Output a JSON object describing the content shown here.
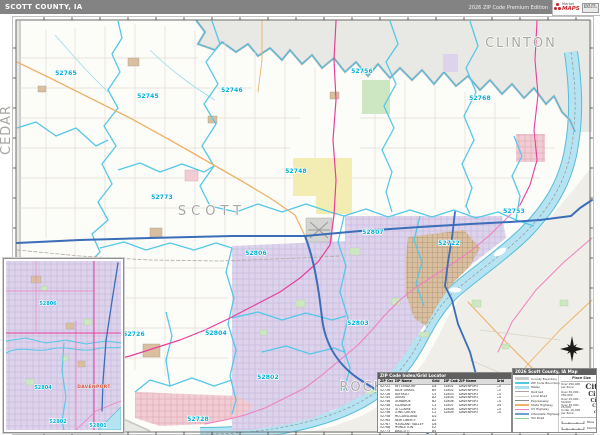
{
  "header": {
    "title": "SCOTT COUNTY, IA",
    "edition": "2026 ZIP Code Premium Edition",
    "logo": {
      "brand_top": "Market",
      "brand_bottom": "MAPS",
      "badge": "2026 ZIP Reference"
    }
  },
  "map": {
    "county_labels": [
      {
        "text": "SCOTT",
        "x": 212,
        "y": 215,
        "size": 13,
        "spacing": 5
      },
      {
        "text": "CLINTON",
        "x": 521,
        "y": 47,
        "size": 11,
        "spacing": 2
      },
      {
        "text": "ROCK ISLAND",
        "x": 395,
        "y": 391,
        "size": 12,
        "spacing": 2
      },
      {
        "text": "CEDAR",
        "x": 10,
        "y": 130,
        "size": 4.5,
        "spacing": 1,
        "rotate": -90
      }
    ],
    "zip_labels": [
      {
        "code": "52765",
        "x": 66,
        "y": 75
      },
      {
        "code": "52745",
        "x": 148,
        "y": 98
      },
      {
        "code": "52746",
        "x": 232,
        "y": 92
      },
      {
        "code": "52756",
        "x": 362,
        "y": 73
      },
      {
        "code": "52768",
        "x": 480,
        "y": 100
      },
      {
        "code": "52748",
        "x": 296,
        "y": 173
      },
      {
        "code": "52773",
        "x": 162,
        "y": 199
      },
      {
        "code": "52753",
        "x": 514,
        "y": 213
      },
      {
        "code": "52807",
        "x": 373,
        "y": 234
      },
      {
        "code": "52806",
        "x": 256,
        "y": 255
      },
      {
        "code": "52722",
        "x": 449,
        "y": 245
      },
      {
        "code": "52804",
        "x": 216,
        "y": 335
      },
      {
        "code": "52803",
        "x": 358,
        "y": 325
      },
      {
        "code": "52802",
        "x": 268,
        "y": 379
      },
      {
        "code": "52726",
        "x": 134,
        "y": 336
      },
      {
        "code": "52728",
        "x": 198,
        "y": 421
      }
    ]
  },
  "inset": {
    "city": {
      "text": "DAVENPORT",
      "x": 88,
      "y": 127
    },
    "zip_labels": [
      {
        "code": "52806",
        "x": 42,
        "y": 44
      },
      {
        "code": "52804",
        "x": 37,
        "y": 128
      },
      {
        "code": "52802",
        "x": 52,
        "y": 162
      },
      {
        "code": "52801",
        "x": 92,
        "y": 166
      }
    ]
  },
  "zip_table": {
    "title": "ZIP Code Index/Grid Locator",
    "columns": [
      "ZIP Code",
      "ZIP Name",
      "Grid"
    ],
    "rows_left": [
      [
        "52722",
        "BETTENDORF",
        "D4"
      ],
      [
        "52726",
        "BLUE GRASS",
        "B5"
      ],
      [
        "52728",
        "BUFFALO",
        "C5"
      ],
      [
        "52745",
        "DIXON",
        "A2"
      ],
      [
        "52746",
        "DONAHUE",
        "B2"
      ],
      [
        "52748",
        "ELDRIDGE",
        "C3"
      ],
      [
        "52753",
        "LE CLAIRE",
        "E3"
      ],
      [
        "52756",
        "LONG GROVE",
        "C2"
      ],
      [
        "52758",
        "MCCAUSLAND",
        "D2"
      ],
      [
        "52765",
        "NEW LIBERTY",
        "A2"
      ],
      [
        "52767",
        "PLEASANT VALLEY",
        "D4"
      ],
      [
        "52768",
        "PRINCETON",
        "E2"
      ],
      [
        "52773",
        "WALCOTT",
        "B4"
      ]
    ],
    "rows_right": [
      [
        "52801",
        "DAVENPORT",
        "C4"
      ],
      [
        "52802",
        "DAVENPORT",
        "C5"
      ],
      [
        "52803",
        "DAVENPORT",
        "C4"
      ],
      [
        "52804",
        "DAVENPORT",
        "C4"
      ],
      [
        "52806",
        "DAVENPORT",
        "C4"
      ],
      [
        "52807",
        "DAVENPORT",
        "D4"
      ],
      [
        "52808",
        "DAVENPORT",
        "C4"
      ],
      [
        "52809",
        "DAVENPORT",
        "C4"
      ]
    ]
  },
  "legend": {
    "title": "2026 Scott County, IA Map",
    "lines": [
      {
        "label": "County Boundary",
        "color": "#c9c9c9",
        "h": 2.6
      },
      {
        "label": "ZIP Code Boundary",
        "color": "#55c8e8",
        "h": 2.2
      },
      {
        "label": "Water",
        "color": "#aadff0",
        "h": 2.6
      },
      {
        "label": "Railroad",
        "color": "#a9a9a9",
        "h": 1
      },
      {
        "label": "Local Road",
        "color": "#d7d2c8",
        "h": 1
      },
      {
        "label": "Expressway",
        "color": "#8d8d8d",
        "h": 1.4
      },
      {
        "label": "State Highway",
        "color": "#eeb268",
        "h": 1.4
      },
      {
        "label": "US Highway",
        "color": "#f07fc0",
        "h": 1.4
      },
      {
        "label": "Interstate Highway",
        "color": "#6f9fd8",
        "h": 1.8
      },
      {
        "label": "Toll Road",
        "color": "#8fce8f",
        "h": 1.4
      }
    ],
    "place_size_title": "Place Size",
    "place_sizes": [
      {
        "range": "Over 250,000 per Zone",
        "sample": "City",
        "size": 7.5
      },
      {
        "range": "Over 50,000 - 250,000",
        "sample": "City",
        "size": 6.2
      },
      {
        "range": "Over 25,000 - 50,000",
        "sample": "City",
        "size": 5.2
      },
      {
        "range": "Over 10,000 - 25,000",
        "sample": "City",
        "size": 4.4
      },
      {
        "range": "Under 10,000 per Zone",
        "sample": "City",
        "size": 3.6
      }
    ],
    "scale": {
      "miles_label": "Miles",
      "km_label": "Kilometers"
    }
  }
}
